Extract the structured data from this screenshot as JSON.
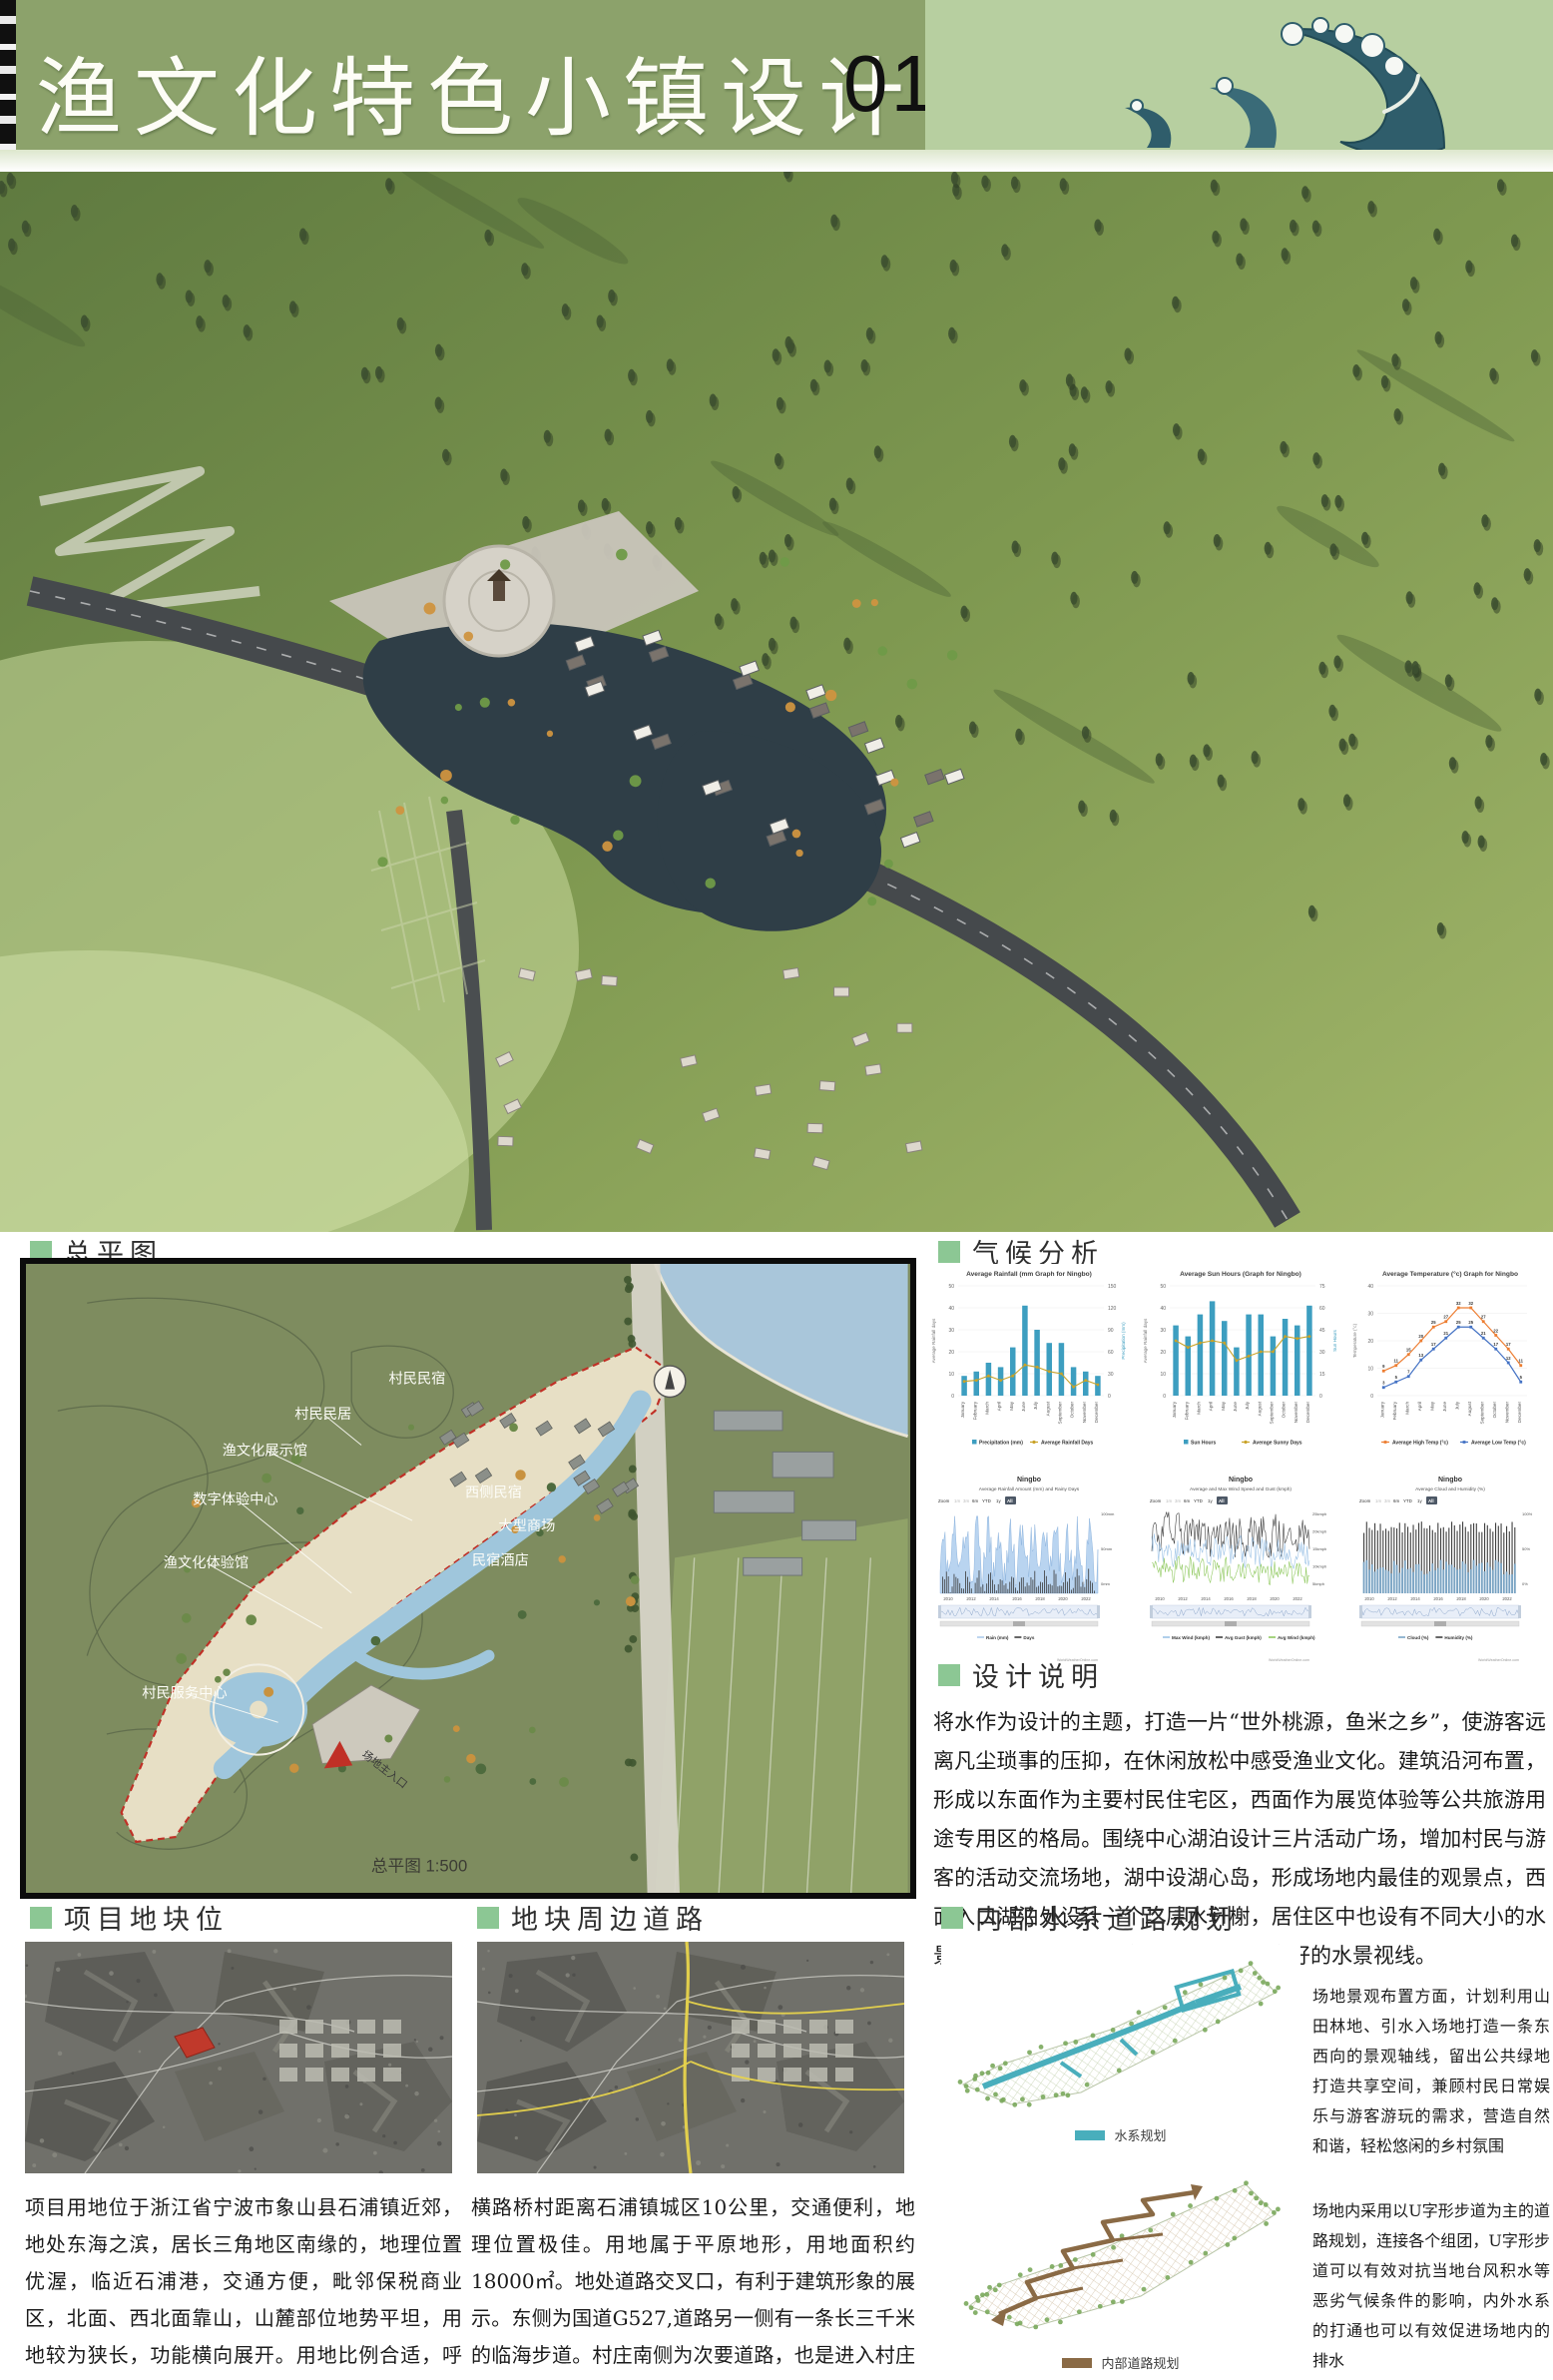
{
  "header": {
    "title": "渔文化特色小镇设计",
    "page_number": "01"
  },
  "sections": {
    "master_plan": {
      "label": "总平图",
      "scale_note": "总平图 1:500",
      "entrance_label": "场地主入口",
      "labels": [
        "村民民宿",
        "村民民居",
        "渔文化展示馆",
        "数字体验中心",
        "渔文化体验馆",
        "村民服务中心",
        "西侧民宿",
        "大型商场",
        "民宿酒店"
      ]
    },
    "climate": {
      "label": "气候分析"
    },
    "design_notes": {
      "label": "设计说明",
      "text": "将水作为设计的主题，打造一片“世外桃源，鱼米之乡”，使游客远离凡尘琐事的压抑，在休闲放松中感受渔业文化。建筑沿河布置，形成以东面作为主要村民住宅区，西面作为展览体验等公共旅游用途专用区的格局。围绕中心湖泊设计三片活动广场，增加村民与游客的活动交流场地，湖中设湖心岛，形成场地内最佳的观景点，西面入口湖泊处设计一个二层水轩榭，居住区中也设有不同大小的水景，确保场地内的任意建筑中都能有良好的水景视线。"
    },
    "site_location": {
      "label": "项目地块位",
      "text": "项目用地位于浙江省宁波市象山县石浦镇近郊，地处东海之滨，居长三角地区南缘的，地理位置优渥，临近石浦港，交通方便，毗邻保税商业区，北面、西北面靠山，山麓部位地势平坦，用地较为狭长，功能横向展开。用地比例合适，呼应周边布局。地块临近国道，利于交通组织。与周边文化建筑呼应，形成良性对话"
    },
    "surrounding_roads": {
      "label": "地块周边道路",
      "text": "横路桥村距离石浦镇城区10公里，交通便利，地理位置极佳。用地属于平原地形，用地面积约18000㎡。地处道路交叉口，有利于建筑形象的展示。东侧为国道G527,道路另一侧有一条长三千米的临海步道。村庄南侧为次要道路，也是进入村庄的唯一道路，村庄北侧道路与南侧次要道路闭合成环"
    },
    "internal_planning": {
      "label": "内部水系道路规划",
      "water_system": {
        "legend": "水系规划",
        "text": "场地景观布置方面，计划利用山田林地、引水入场地打造一条东西向的景观轴线，留出公共绿地打造共享空间，兼顾村民日常娱乐与游客游玩的需求，营造自然和谐，轻松悠闲的乡村氛围"
      },
      "road_system": {
        "legend": "内部道路规划",
        "text": "场地内采用以U字形步道为主的道路规划，连接各个组团，U字形步道可以有效对抗当地台风积水等恶劣气候条件的影响，内外水系的打通也可以有效促进场地内的排水"
      }
    }
  },
  "chart_data": [
    {
      "id": "rainfall",
      "type": "bar",
      "title": "Average Rainfall (mm Graph for Ningbo)",
      "categories": [
        "January",
        "February",
        "March",
        "April",
        "May",
        "June",
        "July",
        "August",
        "September",
        "October",
        "November",
        "December"
      ],
      "series": [
        {
          "name": "Precipitation (mm)",
          "type": "bar",
          "color": "#3d9ec0",
          "values": [
            9,
            11,
            15,
            13,
            22,
            41,
            30,
            24,
            24,
            13,
            11,
            9
          ]
        },
        {
          "name": "Average Rainfall Days",
          "type": "line",
          "color": "#c9a227",
          "values": [
            6.5,
            7,
            9,
            7,
            9,
            14,
            13,
            11,
            10,
            4,
            7,
            5
          ]
        }
      ],
      "ylabel_left": "Average Rainfall days",
      "ylabel_right": "Precipitation (mm)",
      "yticks_left": [
        0,
        10,
        20,
        30,
        40,
        50
      ],
      "yticks_right": [
        0,
        30,
        60,
        90,
        120,
        150
      ]
    },
    {
      "id": "sun_hours",
      "type": "bar",
      "title": "Average Sun Hours (Graph for Ningbo)",
      "categories": [
        "January",
        "February",
        "March",
        "April",
        "May",
        "June",
        "July",
        "August",
        "September",
        "October",
        "November",
        "December"
      ],
      "series": [
        {
          "name": "Sun Hours",
          "type": "bar",
          "color": "#3d9ec0",
          "values": [
            32,
            27,
            37,
            43,
            34,
            22,
            37,
            37,
            27,
            35,
            32,
            41
          ]
        },
        {
          "name": "Average Sunny Days",
          "type": "line",
          "color": "#c9a227",
          "values": [
            25,
            22,
            24,
            25,
            24,
            16,
            18,
            20,
            20,
            27,
            26,
            27
          ]
        }
      ],
      "ylabel_left": "Average Rainfall days",
      "ylabel_right": "Sun Hours",
      "yticks_left": [
        0,
        10,
        20,
        30,
        40,
        50
      ],
      "yticks_right": [
        0,
        15,
        30,
        45,
        60,
        75
      ]
    },
    {
      "id": "temperature",
      "type": "line",
      "title": "Average Temperature (°c) Graph for Ningbo",
      "categories": [
        "January",
        "February",
        "March",
        "April",
        "May",
        "June",
        "July",
        "August",
        "September",
        "October",
        "November",
        "December"
      ],
      "series": [
        {
          "name": "Average High Temp (°c)",
          "type": "line",
          "color": "#ed7d31",
          "values": [
            9,
            11,
            15,
            20,
            25,
            27,
            32,
            32,
            27,
            22,
            17,
            11
          ]
        },
        {
          "name": "Average Low Temp (°c)",
          "type": "line",
          "color": "#4472c4",
          "values": [
            3,
            5,
            7,
            13,
            17,
            21,
            25,
            25,
            21,
            17,
            12,
            5
          ]
        }
      ],
      "ylabel": "Temperature (°c)",
      "yticks": [
        0,
        10,
        20,
        30,
        40
      ]
    },
    {
      "id": "rain_history",
      "type": "area",
      "title": "Ningbo",
      "subtitle": "Average Rainfall Amount (mm) and Rainy Days",
      "toolbar": [
        "Zoom",
        "1m",
        "3m",
        "6m",
        "YTD",
        "1y",
        "All"
      ],
      "x_years": [
        2010,
        2012,
        2014,
        2016,
        2018,
        2020,
        2022
      ],
      "axis_labels_right": [
        "100mm",
        "50mm",
        "0mm"
      ],
      "legend": [
        {
          "label": "Rain (mm)",
          "color": "#aecbeb"
        },
        {
          "label": "Days",
          "color": "#404040"
        }
      ],
      "watermark": "WorldWeatherOnline.com"
    },
    {
      "id": "wind_history",
      "type": "line",
      "title": "Ningbo",
      "subtitle": "Average and Max Wind Speed and Gust (kmph)",
      "toolbar": [
        "Zoom",
        "1m",
        "3m",
        "6m",
        "YTD",
        "1y",
        "All"
      ],
      "x_years": [
        2010,
        2012,
        2014,
        2016,
        2018,
        2020,
        2022
      ],
      "axis_labels_right": [
        "25kmph",
        "20kmph",
        "15kmph",
        "10kmph",
        "5kmph"
      ],
      "legend": [
        {
          "label": "Max Wind (kmph)",
          "color": "#9dc3e6"
        },
        {
          "label": "Avg Gust (kmph)",
          "color": "#404040"
        },
        {
          "label": "Avg Wind (kmph)",
          "color": "#90c960"
        }
      ],
      "watermark": "WorldWeatherOnline.com"
    },
    {
      "id": "cloud_humidity",
      "type": "bar",
      "title": "Ningbo",
      "subtitle": "Average Cloud and Humidity (%)",
      "toolbar": [
        "Zoom",
        "1m",
        "3m",
        "6m",
        "YTD",
        "1y",
        "All"
      ],
      "x_years": [
        2010,
        2012,
        2014,
        2016,
        2018,
        2020,
        2022
      ],
      "axis_labels_right": [
        "100%",
        "50%",
        "0%"
      ],
      "legend": [
        {
          "label": "Cloud (%)",
          "color": "#7ba7c7"
        },
        {
          "label": "Humidity (%)",
          "color": "#404040"
        }
      ],
      "watermark": "WorldWeatherOnline.com"
    }
  ],
  "colors": {
    "header_green": "#8CA26B",
    "wave_panel": "#B7CFA0",
    "bullet_green": "#8CC794",
    "chart_teal": "#3d9ec0",
    "water_blue": "#9FC6DC",
    "boundary_red": "#C03026",
    "water_system_teal": "#49AEBC",
    "road_system_brown": "#8A6A45"
  }
}
